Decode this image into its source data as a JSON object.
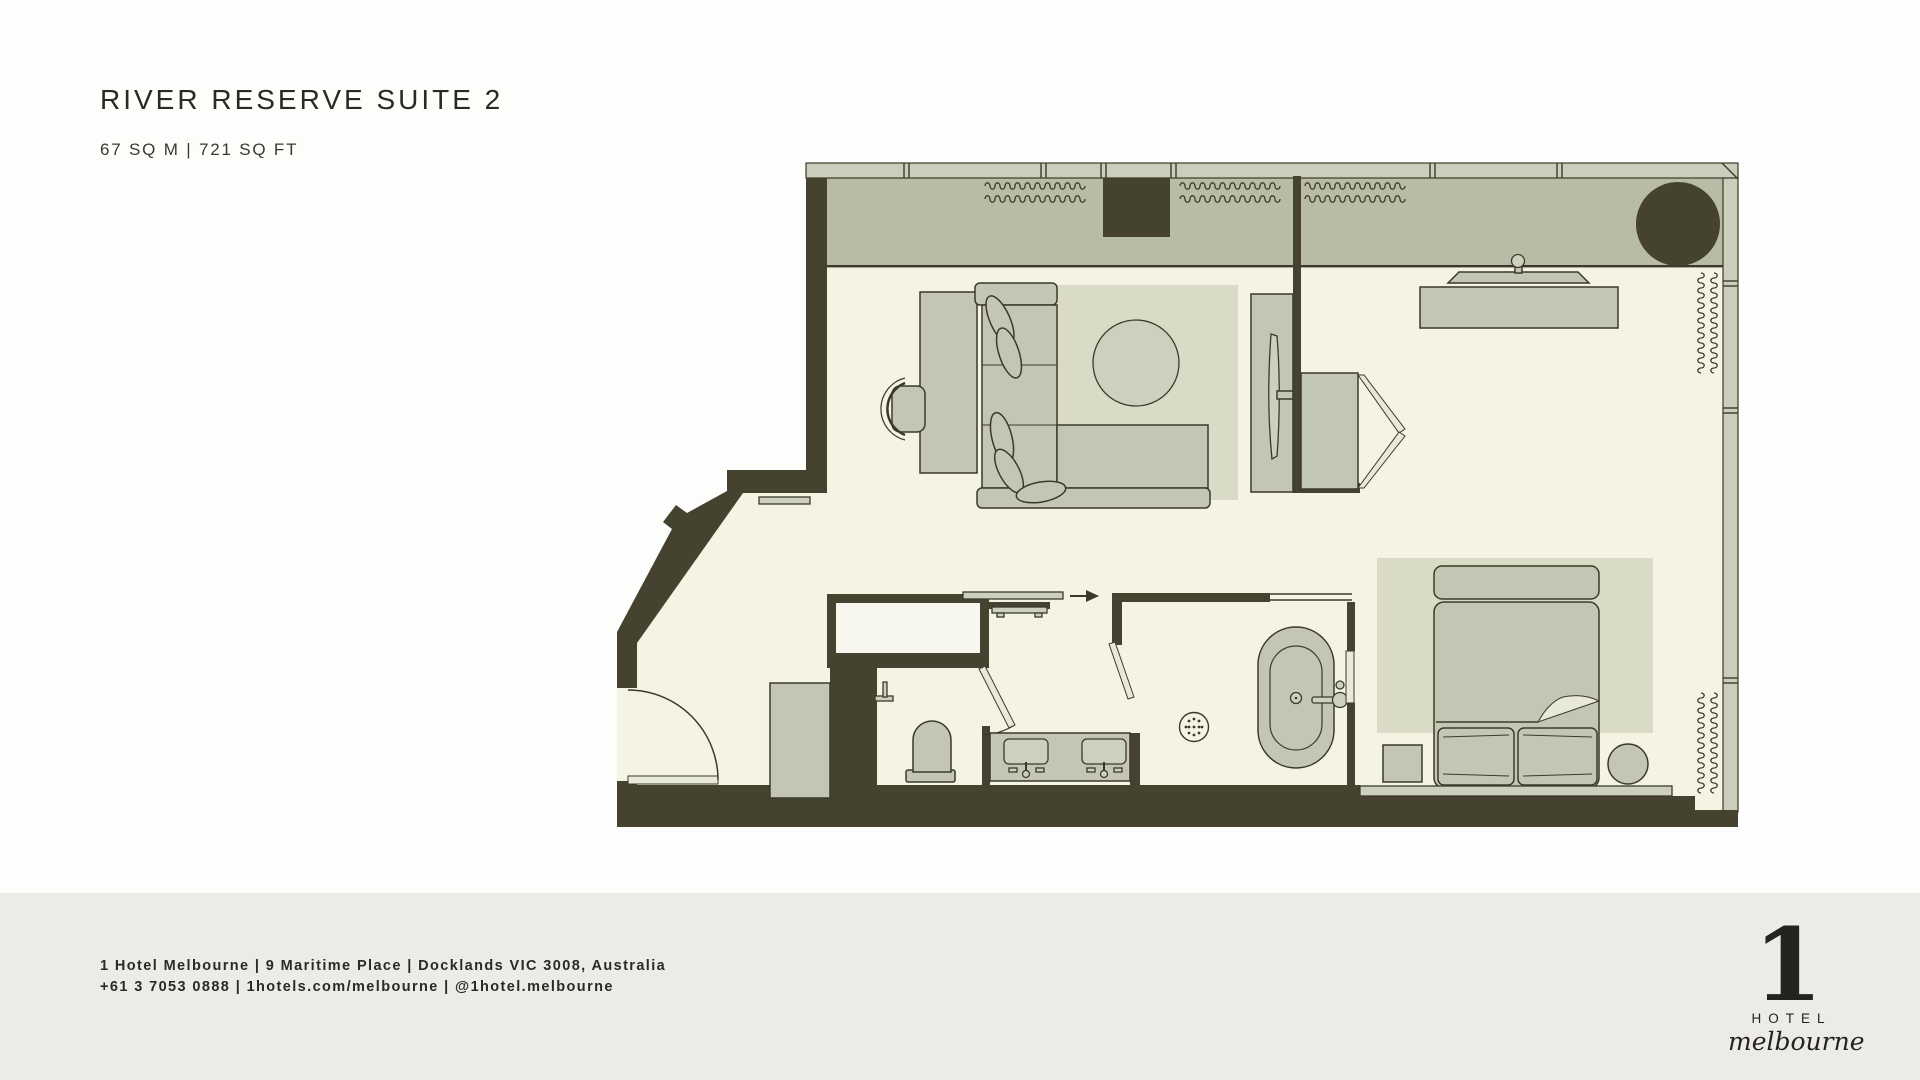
{
  "header": {
    "title": "RIVER RESERVE SUITE 2",
    "area": "67 SQ M | 721 SQ FT"
  },
  "footer": {
    "line1": "1 Hotel Melbourne | 9 Maritime Place | Docklands VIC 3008, Australia",
    "line2": "+61 3 7053 0888 | 1hotels.com/melbourne | @1hotel.melbourne"
  },
  "logo": {
    "numeral": "1",
    "word": "HOTEL",
    "script": "melbourne"
  },
  "colors": {
    "wall": "#45432f",
    "ink": "#3b3a28",
    "floor": "#f5f3e2",
    "terrace": "#b8bba6",
    "furniture": "#c3c6b2",
    "rug": "#d9dbc7",
    "window": "#caceba",
    "page": "#fdfdfb",
    "footer_band": "#edebe5",
    "white_inset": "#f8f7ef",
    "door": "#e9e9d8"
  }
}
